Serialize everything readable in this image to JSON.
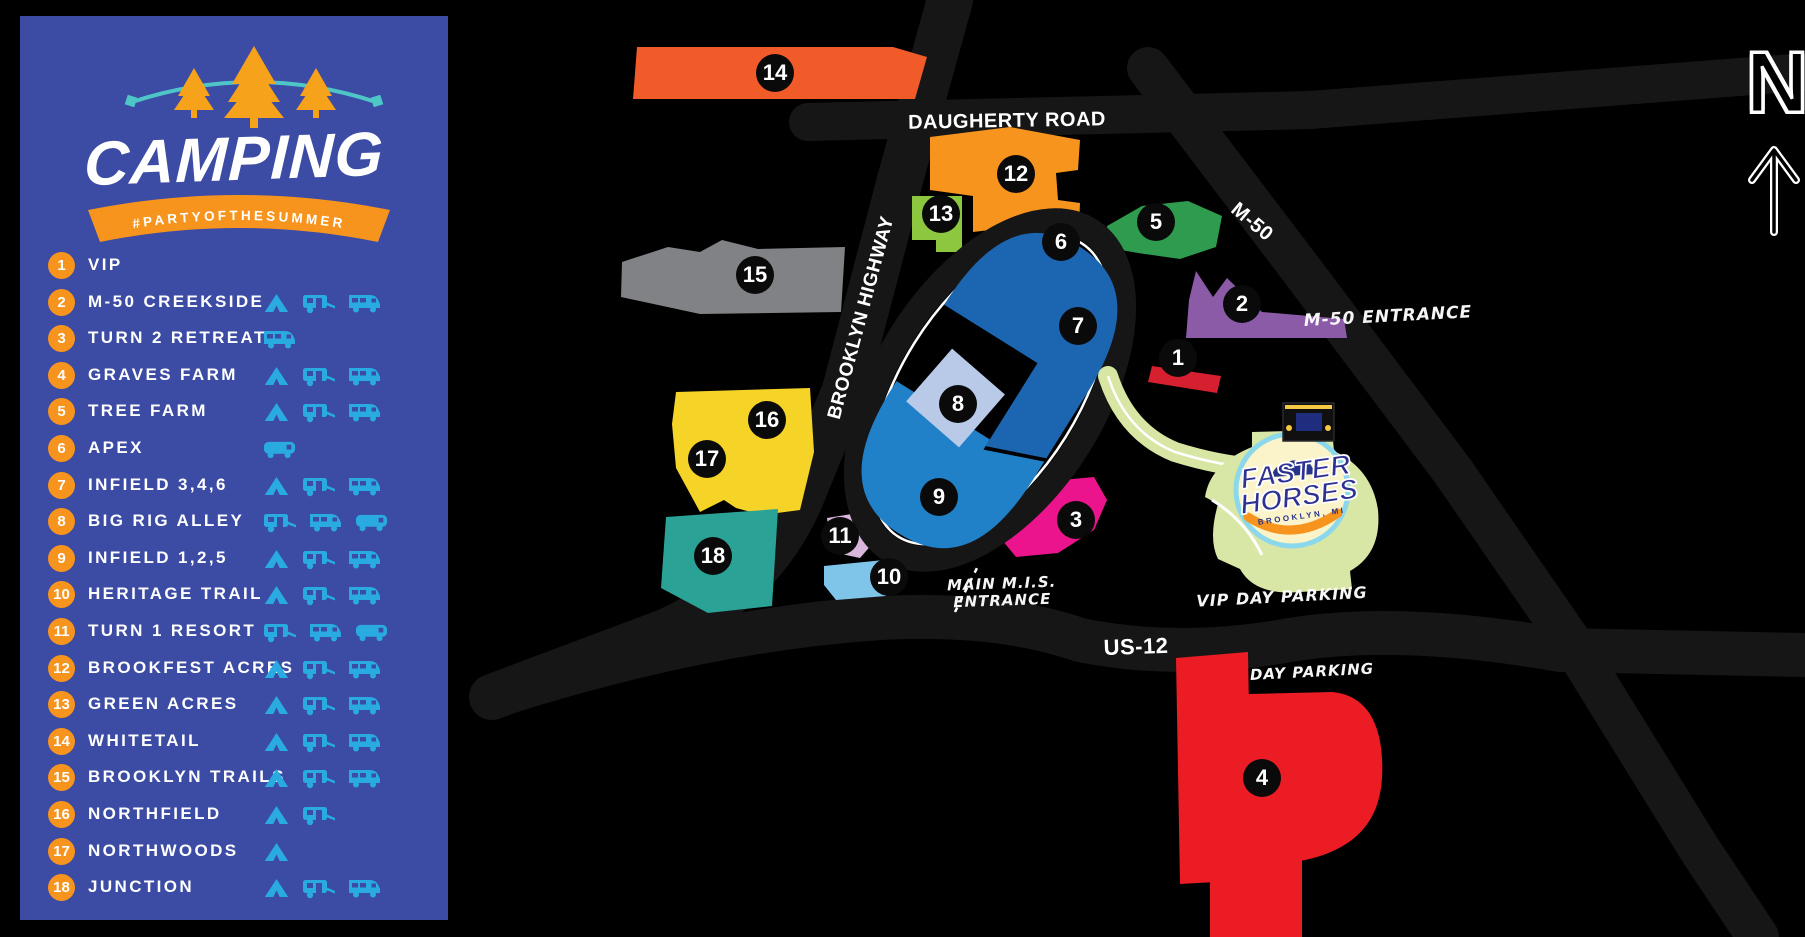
{
  "header": {
    "title": "CAMPING",
    "hashtag": "#PARTYOFTHESUMMER"
  },
  "legend": {
    "items": [
      {
        "num": "1",
        "label": "VIP",
        "icons": []
      },
      {
        "num": "2",
        "label": "M-50 CREEKSIDE",
        "icons": [
          "tent",
          "trailer",
          "rv"
        ]
      },
      {
        "num": "3",
        "label": "TURN 2 RETREAT",
        "icons": [
          "rv"
        ]
      },
      {
        "num": "4",
        "label": "GRAVES FARM",
        "icons": [
          "tent",
          "trailer",
          "rv"
        ]
      },
      {
        "num": "5",
        "label": "TREE FARM",
        "icons": [
          "tent",
          "trailer",
          "rv"
        ]
      },
      {
        "num": "6",
        "label": "APEX",
        "icons": [
          "bus"
        ]
      },
      {
        "num": "7",
        "label": "INFIELD 3,4,6",
        "icons": [
          "tent",
          "trailer",
          "rv"
        ]
      },
      {
        "num": "8",
        "label": "BIG RIG ALLEY",
        "icons": [
          "trailer",
          "rv",
          "bus"
        ]
      },
      {
        "num": "9",
        "label": "INFIELD 1,2,5",
        "icons": [
          "tent",
          "trailer",
          "rv"
        ]
      },
      {
        "num": "10",
        "label": "HERITAGE TRAIL",
        "icons": [
          "tent",
          "trailer",
          "rv"
        ]
      },
      {
        "num": "11",
        "label": "TURN 1 RESORT",
        "icons": [
          "trailer",
          "rv",
          "bus"
        ]
      },
      {
        "num": "12",
        "label": "BROOKFEST ACRES",
        "icons": [
          "tent",
          "trailer",
          "rv"
        ]
      },
      {
        "num": "13",
        "label": "GREEN ACRES",
        "icons": [
          "tent",
          "trailer",
          "rv"
        ]
      },
      {
        "num": "14",
        "label": "WHITETAIL",
        "icons": [
          "tent",
          "trailer",
          "rv"
        ]
      },
      {
        "num": "15",
        "label": "BROOKLYN TRAILS",
        "icons": [
          "tent",
          "trailer",
          "rv"
        ]
      },
      {
        "num": "16",
        "label": "NORTHFIELD",
        "icons": [
          "tent",
          "trailer"
        ]
      },
      {
        "num": "17",
        "label": "NORTHWOODS",
        "icons": [
          "tent"
        ]
      },
      {
        "num": "18",
        "label": "JUNCTION",
        "icons": [
          "tent",
          "trailer",
          "rv"
        ]
      }
    ]
  },
  "map": {
    "compass": "N",
    "labels": [
      {
        "id": "daugherty-road",
        "text": "DAUGHERTY ROAD",
        "x": 1007,
        "y": 121,
        "rot": -1,
        "size": 20,
        "style": "road"
      },
      {
        "id": "m50-road",
        "text": "M-50",
        "x": 1252,
        "y": 222,
        "rot": 40,
        "size": 20,
        "style": "road"
      },
      {
        "id": "brooklyn-highway",
        "text": "BROOKLYN HIGHWAY",
        "x": 862,
        "y": 318,
        "rot": -75,
        "size": 19,
        "style": "road"
      },
      {
        "id": "us-12",
        "text": "US-12",
        "x": 1136,
        "y": 647,
        "rot": -2,
        "size": 22,
        "style": "road"
      },
      {
        "id": "m50-entrance",
        "text": "M-50 ENTRANCE",
        "x": 1388,
        "y": 317,
        "rot": -3,
        "size": 17,
        "style": "hand"
      },
      {
        "id": "vip-day-parking",
        "text": "VIP DAY PARKING",
        "x": 1282,
        "y": 597,
        "rot": -3,
        "size": 16,
        "style": "hand"
      },
      {
        "id": "day-parking",
        "text": "DAY PARKING",
        "x": 1312,
        "y": 672,
        "rot": -3,
        "size": 15,
        "style": "hand"
      },
      {
        "id": "main-mis-entrance",
        "text": "MAIN M.I.S.\nENTRANCE",
        "x": 1002,
        "y": 592,
        "rot": -2,
        "size": 15,
        "style": "hand"
      }
    ],
    "markers": [
      {
        "n": "1",
        "x": 1178,
        "y": 358
      },
      {
        "n": "2",
        "x": 1242,
        "y": 304
      },
      {
        "n": "3",
        "x": 1076,
        "y": 520
      },
      {
        "n": "4",
        "x": 1262,
        "y": 778
      },
      {
        "n": "5",
        "x": 1156,
        "y": 222
      },
      {
        "n": "6",
        "x": 1061,
        "y": 242
      },
      {
        "n": "7",
        "x": 1078,
        "y": 326
      },
      {
        "n": "8",
        "x": 958,
        "y": 404
      },
      {
        "n": "9",
        "x": 939,
        "y": 497
      },
      {
        "n": "10",
        "x": 889,
        "y": 577
      },
      {
        "n": "11",
        "x": 840,
        "y": 536
      },
      {
        "n": "12",
        "x": 1016,
        "y": 174
      },
      {
        "n": "13",
        "x": 941,
        "y": 214
      },
      {
        "n": "14",
        "x": 775,
        "y": 73
      },
      {
        "n": "15",
        "x": 755,
        "y": 275
      },
      {
        "n": "16",
        "x": 767,
        "y": 420
      },
      {
        "n": "17",
        "x": 707,
        "y": 459
      },
      {
        "n": "18",
        "x": 713,
        "y": 556
      }
    ],
    "zone_colors": {
      "1": "#D6202F",
      "2": "#8C5BA8",
      "3": "#EC148C",
      "4": "#EC1C24",
      "5": "#2E9B4E",
      "6": "#9059A5",
      "7": "#1B65B1",
      "8": "#B9C9E8",
      "9": "#2080C8",
      "10": "#7FC5EA",
      "11": "#D9B6DC",
      "12": "#F7941E",
      "13": "#8DC63F",
      "14": "#F15A29",
      "15": "#808285",
      "16": "#F5D327",
      "17": "#F5D327",
      "18": "#2AA396"
    },
    "logo": {
      "top": "FASTER",
      "bottom": "HORSES",
      "sub": "BROOKLYN, MI"
    }
  },
  "colors": {
    "sidebar_bg": "#3C4BA4",
    "legend_number_bg": "#F7941E",
    "legend_icon": "#29ABE2",
    "marker_bg": "#0A0A0A",
    "road": "#161616",
    "tree_orange": "#F7A21B",
    "lights_teal": "#4EC6C8",
    "path_green": "#D7E6A3",
    "logo_blob": "#D9E7A6",
    "logo_ring": "#8BD7EC",
    "logo_inner": "#FBF3C9",
    "logo_navy": "#27348B",
    "logo_swoosh": "#F7941E"
  }
}
